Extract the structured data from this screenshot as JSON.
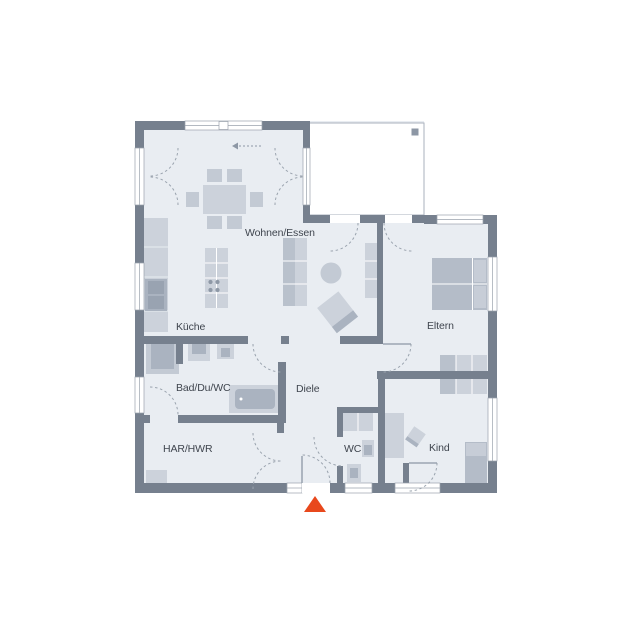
{
  "plan": {
    "type": "floor-plan",
    "rooms": [
      {
        "name": "wohnen-essen",
        "label": "Wohnen/Essen"
      },
      {
        "name": "kueche",
        "label": "Küche"
      },
      {
        "name": "eltern",
        "label": "Eltern"
      },
      {
        "name": "bad-du-wc",
        "label": "Bad/Du/WC"
      },
      {
        "name": "diele",
        "label": "Diele"
      },
      {
        "name": "har-hwr",
        "label": "HAR/HWR"
      },
      {
        "name": "wc",
        "label": "WC"
      },
      {
        "name": "kind",
        "label": "Kind"
      }
    ],
    "colors": {
      "wall": "#76808e",
      "floor": "#e9edf2",
      "furniture_light": "#ccd2db",
      "furniture_dark": "#aab3c0",
      "door_arc": "#9aa3ae",
      "label_text": "#3f454e",
      "entrance_marker": "#e8481c"
    }
  }
}
